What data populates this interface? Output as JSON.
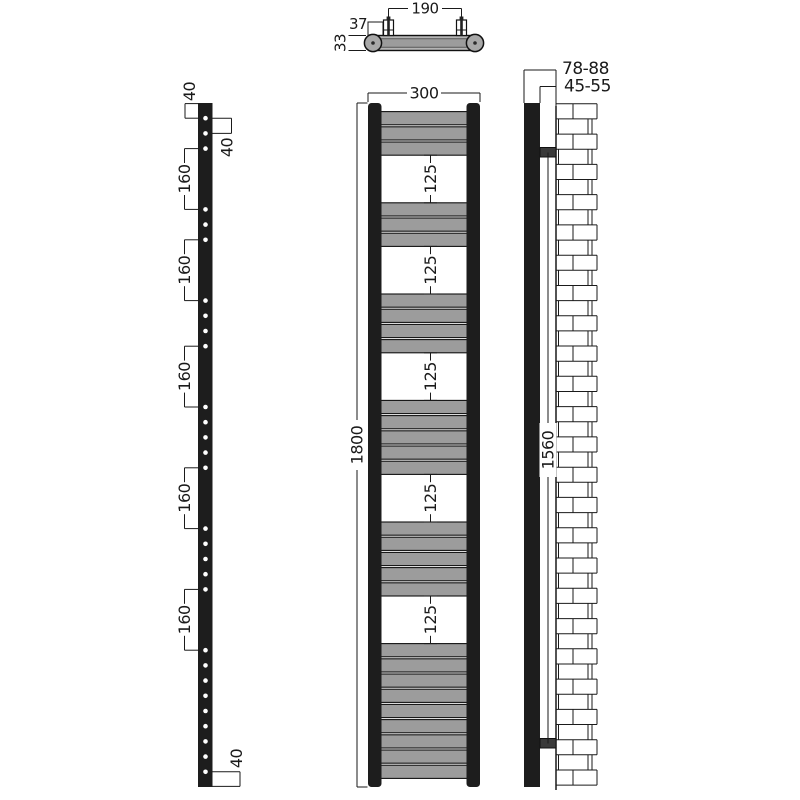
{
  "palette": {
    "line": "#1a1a1a",
    "metal_dark": "#1d1d1d",
    "rail_gray": "#9c9c9c",
    "body_gray": "#b4b4b4",
    "bracket_gray": "#3a3a3a",
    "background": "#ffffff"
  },
  "views": {
    "plan": {
      "bracket_spacing_label": "190",
      "bracket_offset_label": "37",
      "depth_label": "33"
    },
    "profile": {
      "top_offset_label": "40",
      "bar_pitch_label": "40",
      "section_spacing_labels": [
        "160",
        "160",
        "160",
        "160",
        "160"
      ],
      "bottom_offset_label": "40"
    },
    "front": {
      "width_label": "300",
      "height_label": "1800",
      "gap_labels": [
        "125",
        "125",
        "125",
        "125",
        "125"
      ],
      "bar_sections": [
        3,
        3,
        4,
        5,
        5,
        9
      ]
    },
    "wall": {
      "wall_distance_label": "78-88",
      "bracket_distance_label": "45-55",
      "bracket_centres_label": "1560"
    }
  }
}
